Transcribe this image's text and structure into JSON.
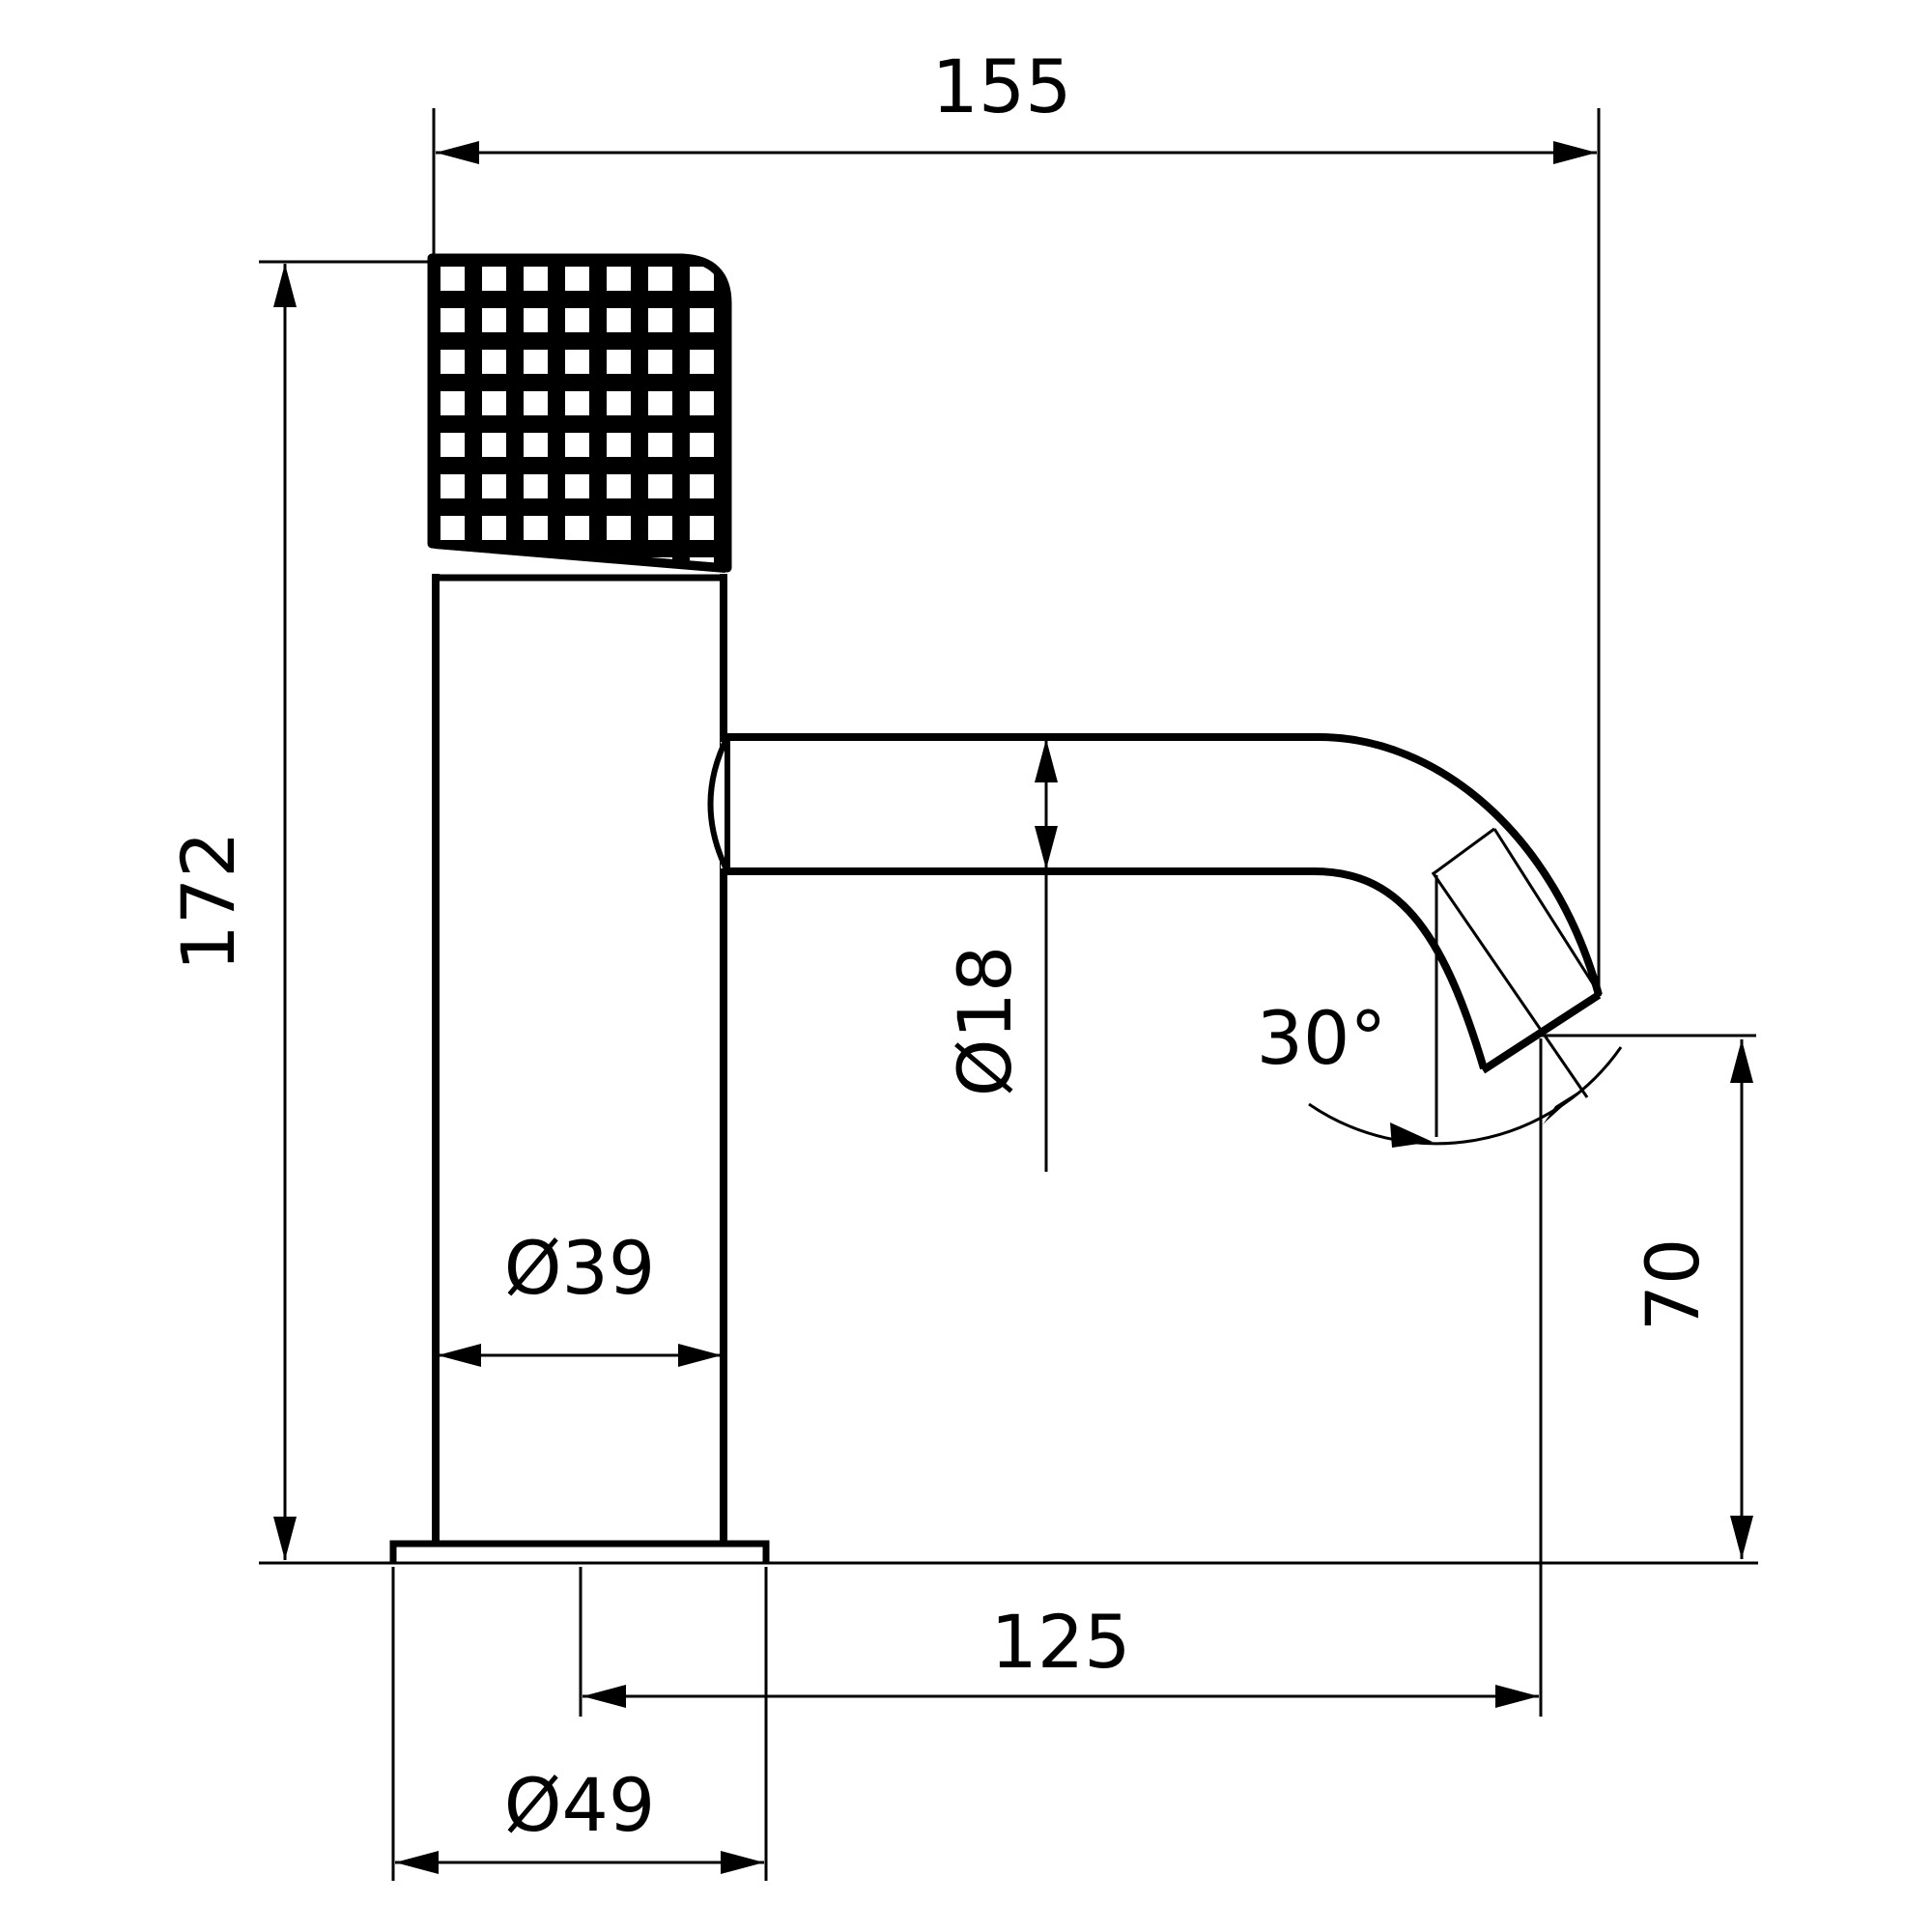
{
  "drawing": {
    "background_color": "#ffffff",
    "line_color": "#000000",
    "dimensions": {
      "overall_depth": {
        "label": "155"
      },
      "overall_height": {
        "label": "172"
      },
      "spout_diameter": {
        "label": "Ø18"
      },
      "spout_angle": {
        "label": "30°"
      },
      "body_diameter": {
        "label": "Ø39"
      },
      "outlet_height": {
        "label": "70"
      },
      "spout_reach": {
        "label": "125"
      },
      "base_diameter": {
        "label": "Ø49"
      }
    }
  }
}
